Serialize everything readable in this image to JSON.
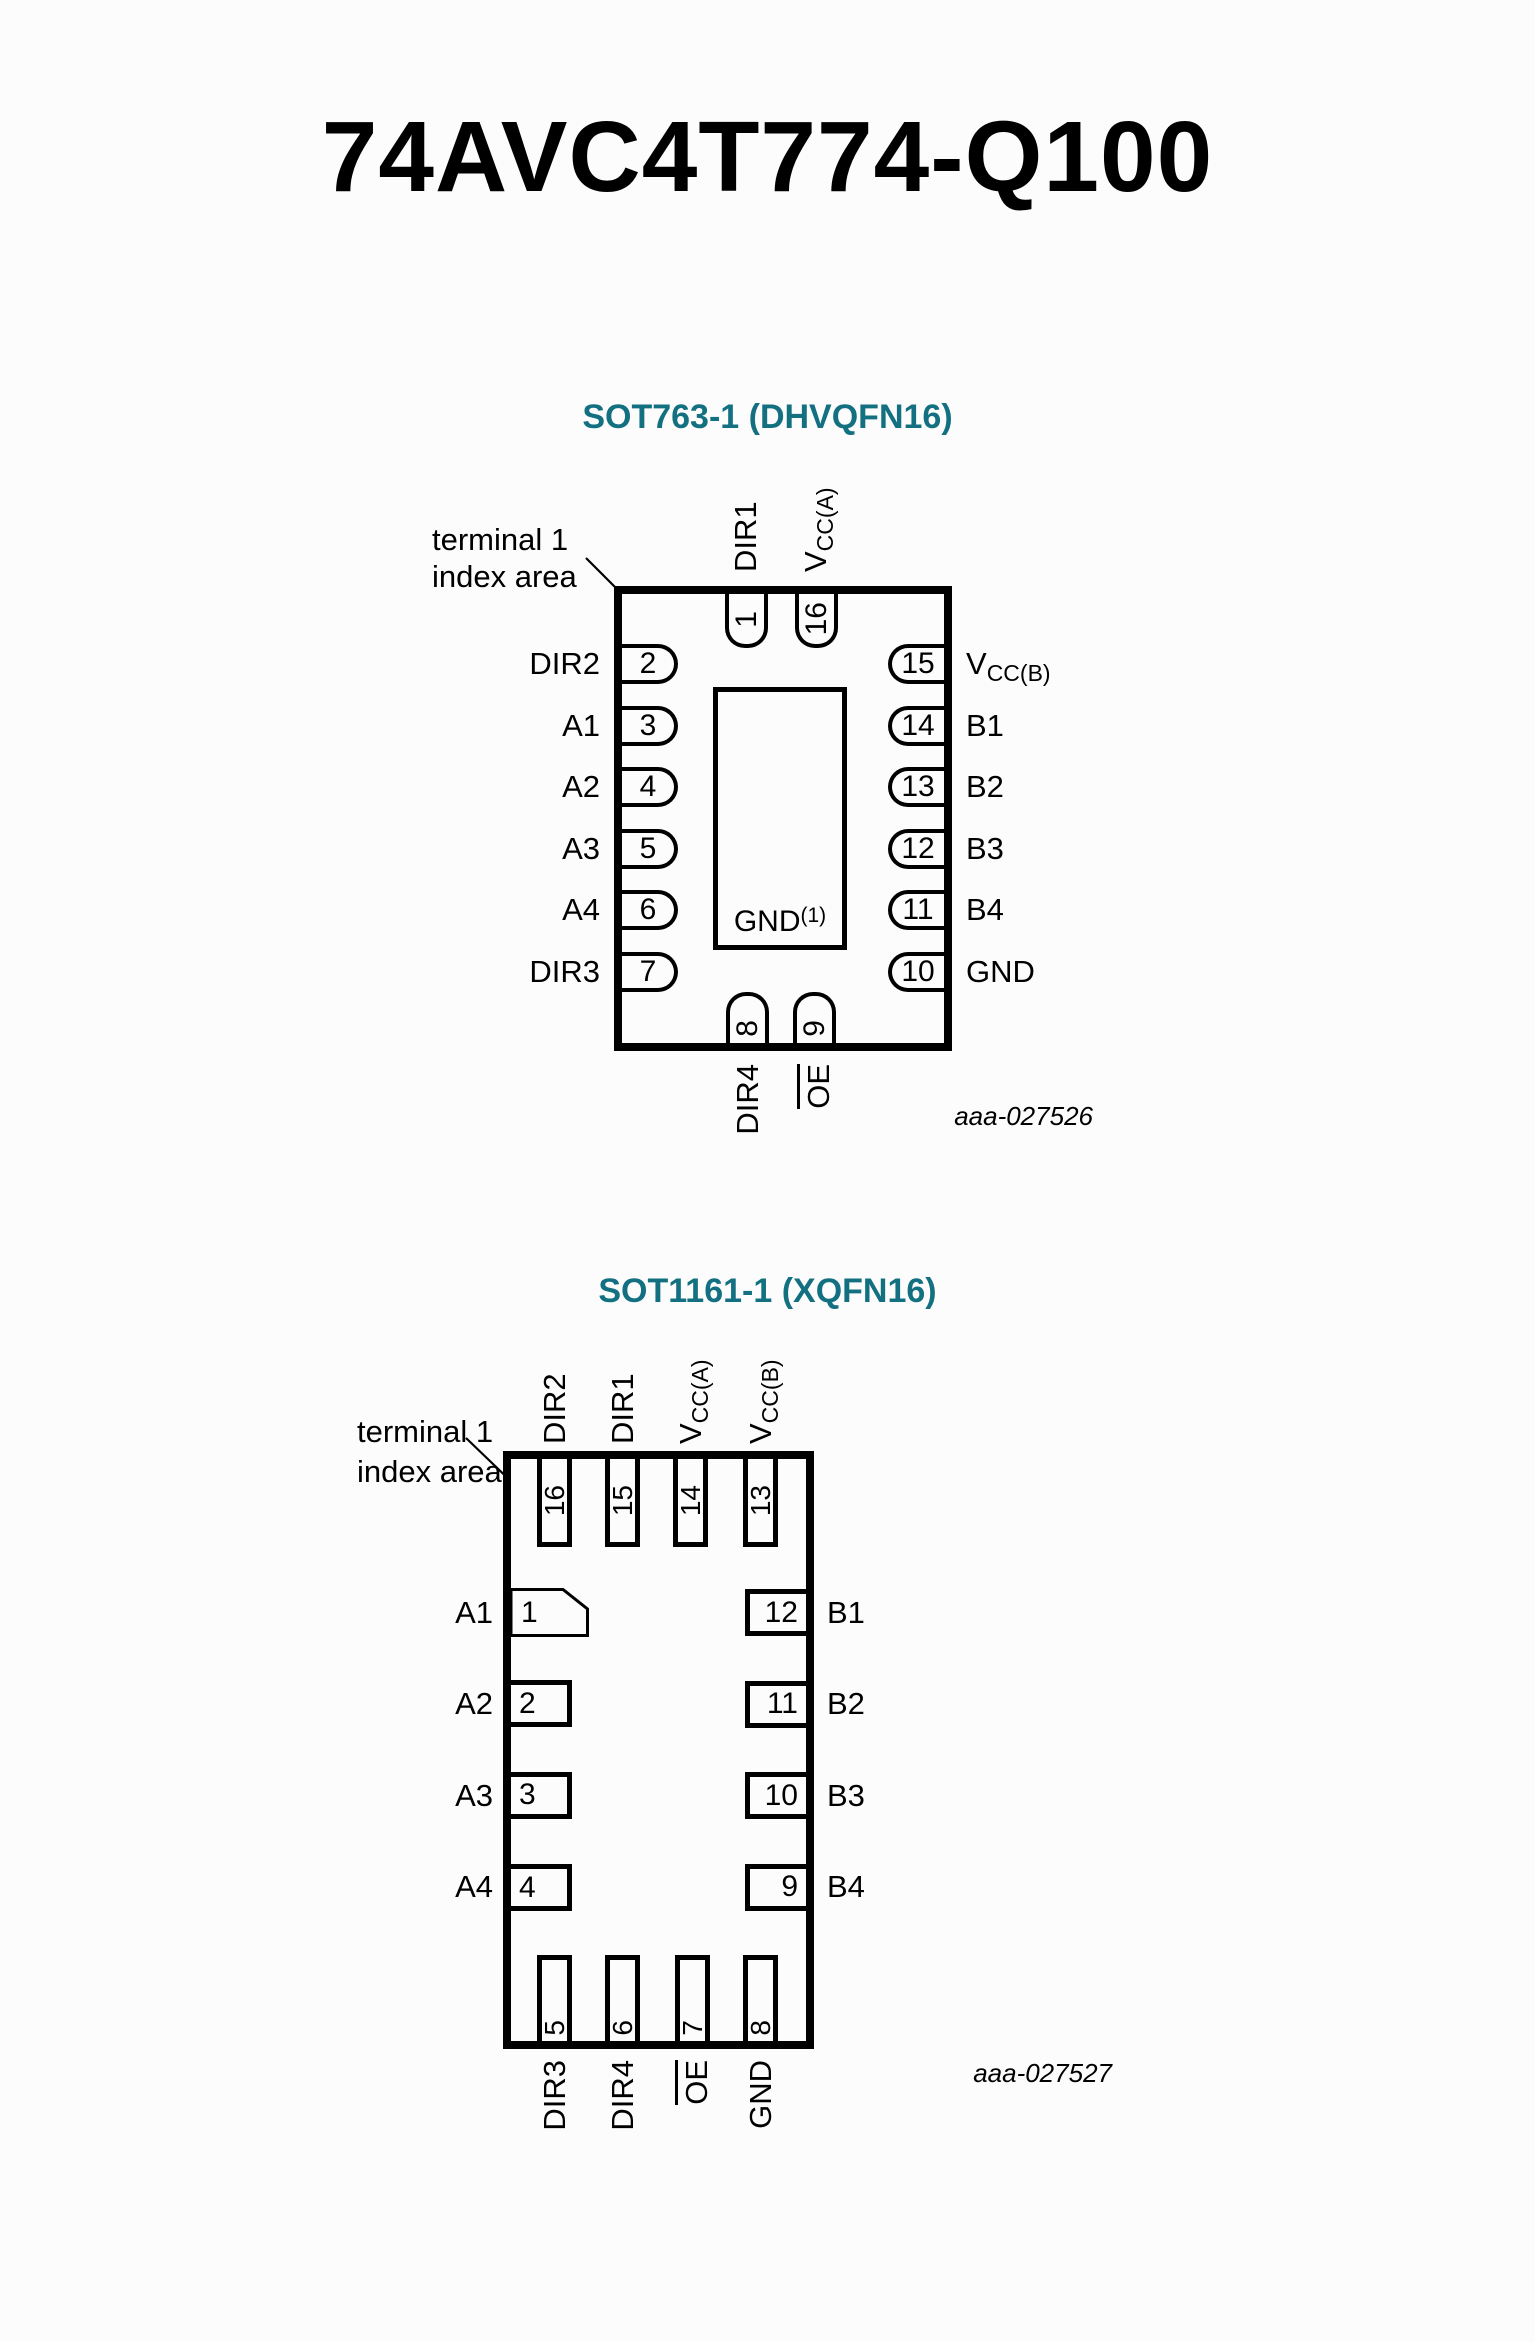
{
  "page": {
    "title": "74AVC4T774-Q100",
    "background": "#fcfcfc"
  },
  "colors": {
    "heading_teal": "#137080",
    "diagram_black": "#000000"
  },
  "figure1": {
    "heading": "SOT763-1 (DHVQFN16)",
    "index_note": {
      "line1": "terminal 1",
      "line2": "index area"
    },
    "center_pad": {
      "label": "GND",
      "superscript": "(1)"
    },
    "figure_code": "aaa-027526",
    "top_pins": [
      {
        "num": "1",
        "label": "DIR1"
      },
      {
        "num": "16",
        "label_base": "V",
        "label_sub": "CC(A)"
      }
    ],
    "left_pins": [
      {
        "num": "2",
        "label": "DIR2"
      },
      {
        "num": "3",
        "label": "A1"
      },
      {
        "num": "4",
        "label": "A2"
      },
      {
        "num": "5",
        "label": "A3"
      },
      {
        "num": "6",
        "label": "A4"
      },
      {
        "num": "7",
        "label": "DIR3"
      }
    ],
    "right_pins": [
      {
        "num": "15",
        "label_base": "V",
        "label_sub": "CC(B)"
      },
      {
        "num": "14",
        "label": "B1"
      },
      {
        "num": "13",
        "label": "B2"
      },
      {
        "num": "12",
        "label": "B3"
      },
      {
        "num": "11",
        "label": "B4"
      },
      {
        "num": "10",
        "label": "GND"
      }
    ],
    "bottom_pins": [
      {
        "num": "8",
        "label": "DIR4",
        "overline": false
      },
      {
        "num": "9",
        "label": "OE",
        "overline": true
      }
    ]
  },
  "figure2": {
    "heading": "SOT1161-1 (XQFN16)",
    "index_note": {
      "line1": "terminal 1",
      "line2": "index area"
    },
    "figure_code": "aaa-027527",
    "top_pins": [
      {
        "num": "16",
        "label": "DIR2"
      },
      {
        "num": "15",
        "label": "DIR1"
      },
      {
        "num": "14",
        "label_base": "V",
        "label_sub": "CC(A)"
      },
      {
        "num": "13",
        "label_base": "V",
        "label_sub": "CC(B)"
      }
    ],
    "left_pins": [
      {
        "num": "1",
        "label": "A1"
      },
      {
        "num": "2",
        "label": "A2"
      },
      {
        "num": "3",
        "label": "A3"
      },
      {
        "num": "4",
        "label": "A4"
      }
    ],
    "right_pins": [
      {
        "num": "12",
        "label": "B1"
      },
      {
        "num": "11",
        "label": "B2"
      },
      {
        "num": "10",
        "label": "B3"
      },
      {
        "num": "9",
        "label": "B4"
      }
    ],
    "bottom_pins": [
      {
        "num": "5",
        "label": "DIR3",
        "overline": false
      },
      {
        "num": "6",
        "label": "DIR4",
        "overline": false
      },
      {
        "num": "7",
        "label": "OE",
        "overline": true
      },
      {
        "num": "8",
        "label": "GND",
        "overline": false
      }
    ]
  }
}
